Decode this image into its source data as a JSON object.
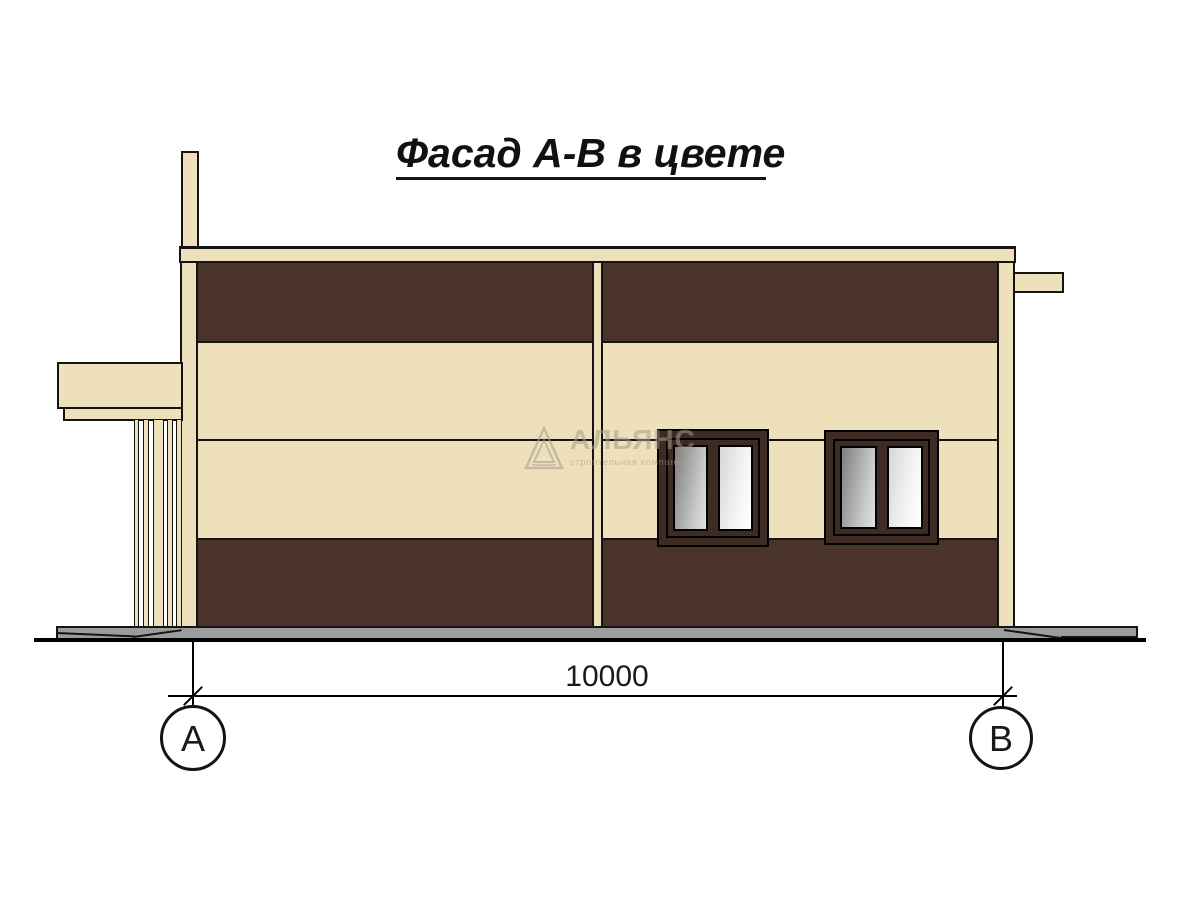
{
  "title": "Фасад А-В в цвете",
  "dimension": {
    "value": "10000"
  },
  "axes": {
    "left_label": "А",
    "right_label": "В"
  },
  "watermark": {
    "name": "АЛЬЯНС",
    "subtitle": "строительная компания"
  },
  "colors": {
    "cream": "#EDE0BA",
    "brown": "#4A332B",
    "frame": "#3E2B23",
    "ground": "#9C9C9C",
    "outline": "#141414",
    "glass_dark": "#7F7F7F",
    "glass_light": "#FFFFFF"
  }
}
